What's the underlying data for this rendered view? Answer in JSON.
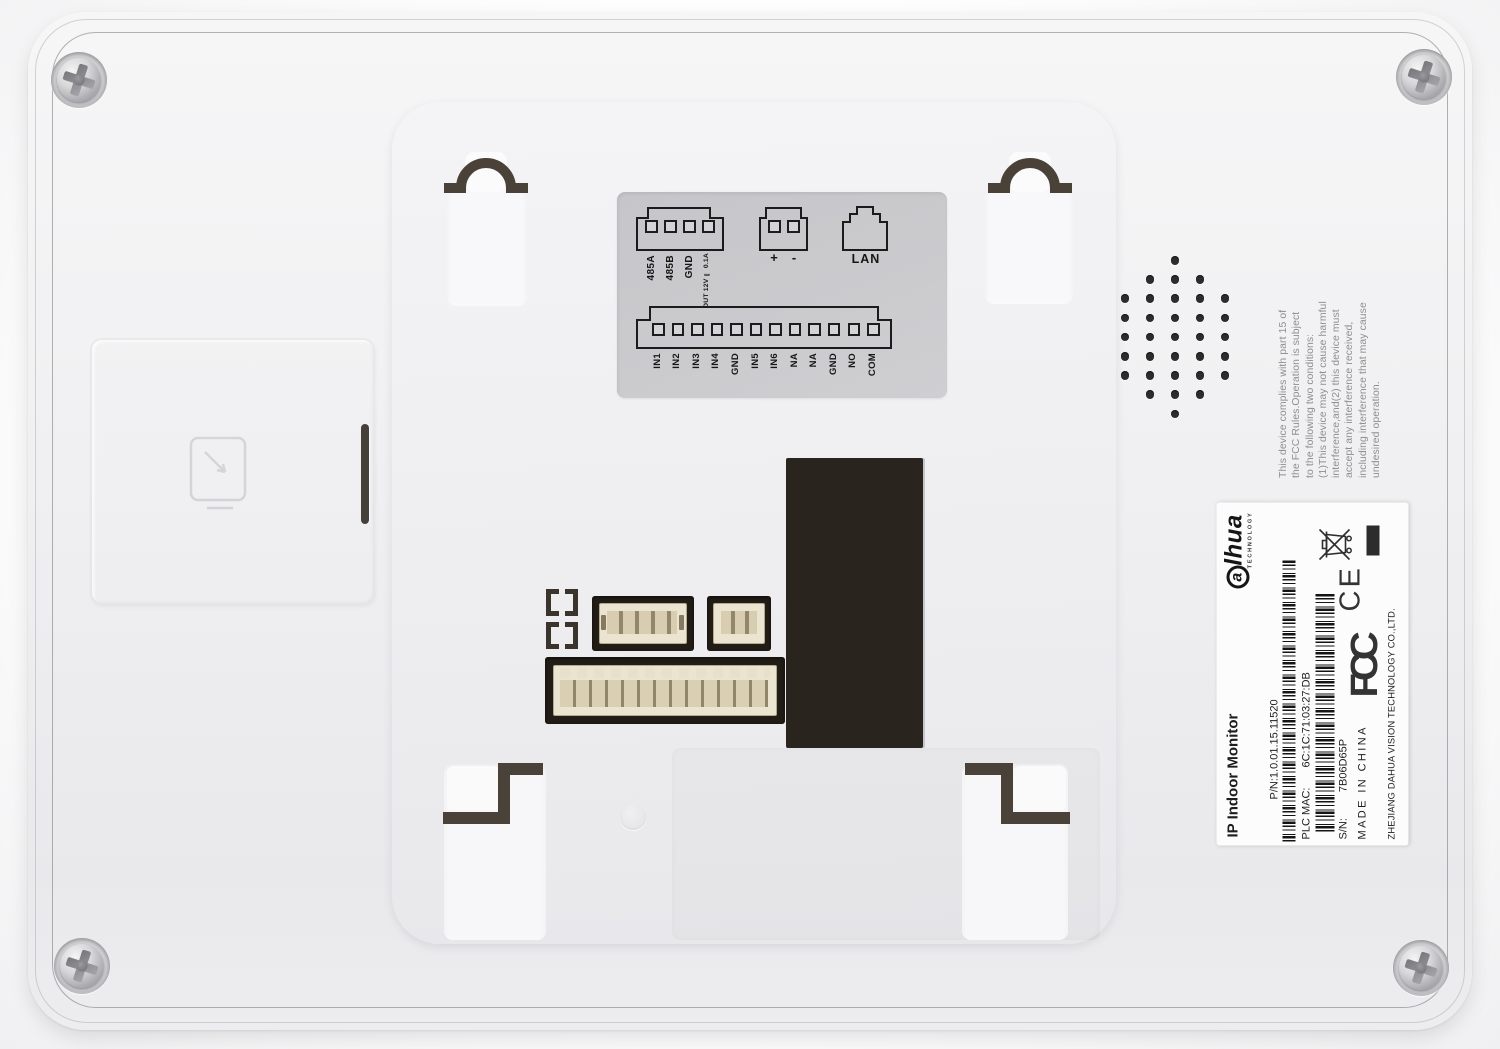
{
  "wiring_label": {
    "rs485_pins": [
      "485A",
      "485B",
      "GND"
    ],
    "power_output_rating": "OUT 12V ⎓ 0.1A",
    "dc_terminal_pins": [
      "+",
      "-"
    ],
    "lan_port_label": "LAN",
    "io_pins": [
      "IN1",
      "IN2",
      "IN3",
      "IN4",
      "GND",
      "IN5",
      "IN6",
      "NA",
      "NA",
      "GND",
      "NO",
      "COM"
    ]
  },
  "fcc_statement": "This device complies with part 15 of\nthe FCC Rules.Operation is subject\nto the following two conditions:\n(1)This device may not cause harmful\ninterference,and(2) this device must\naccept any interference received,\nincluding interference that may cause\nundesired operation.",
  "product_label": {
    "brand_logo": "a",
    "brand_logo_rest": "lhua",
    "brand_sub": "TECHNOLOGY",
    "product_name": "IP Indoor Monitor",
    "part_number": "P/N:1.0.01.15.11520",
    "plc_mac_label": "PLC MAC:",
    "plc_mac_value": "6C:1C:71:03:27:DB",
    "serial_label": "S/N:",
    "serial_value": "7B06D65P",
    "origin": "MADE IN CHINA",
    "manufacturer": "ZHEJIANG DAHUA VISION TECHNOLOGY CO.,LTD.",
    "fcc_mark": "FCC",
    "ce_mark": "CE"
  },
  "speaker_grille_rows": [
    1,
    3,
    5,
    5,
    5,
    5,
    5,
    3,
    1
  ],
  "colors": {
    "body": "#f0f0f2",
    "label_background": "#c9c9cc",
    "slot_accent": "#4a4138",
    "connector_window": "#2a241f",
    "sticker": "#fcfcfd"
  }
}
